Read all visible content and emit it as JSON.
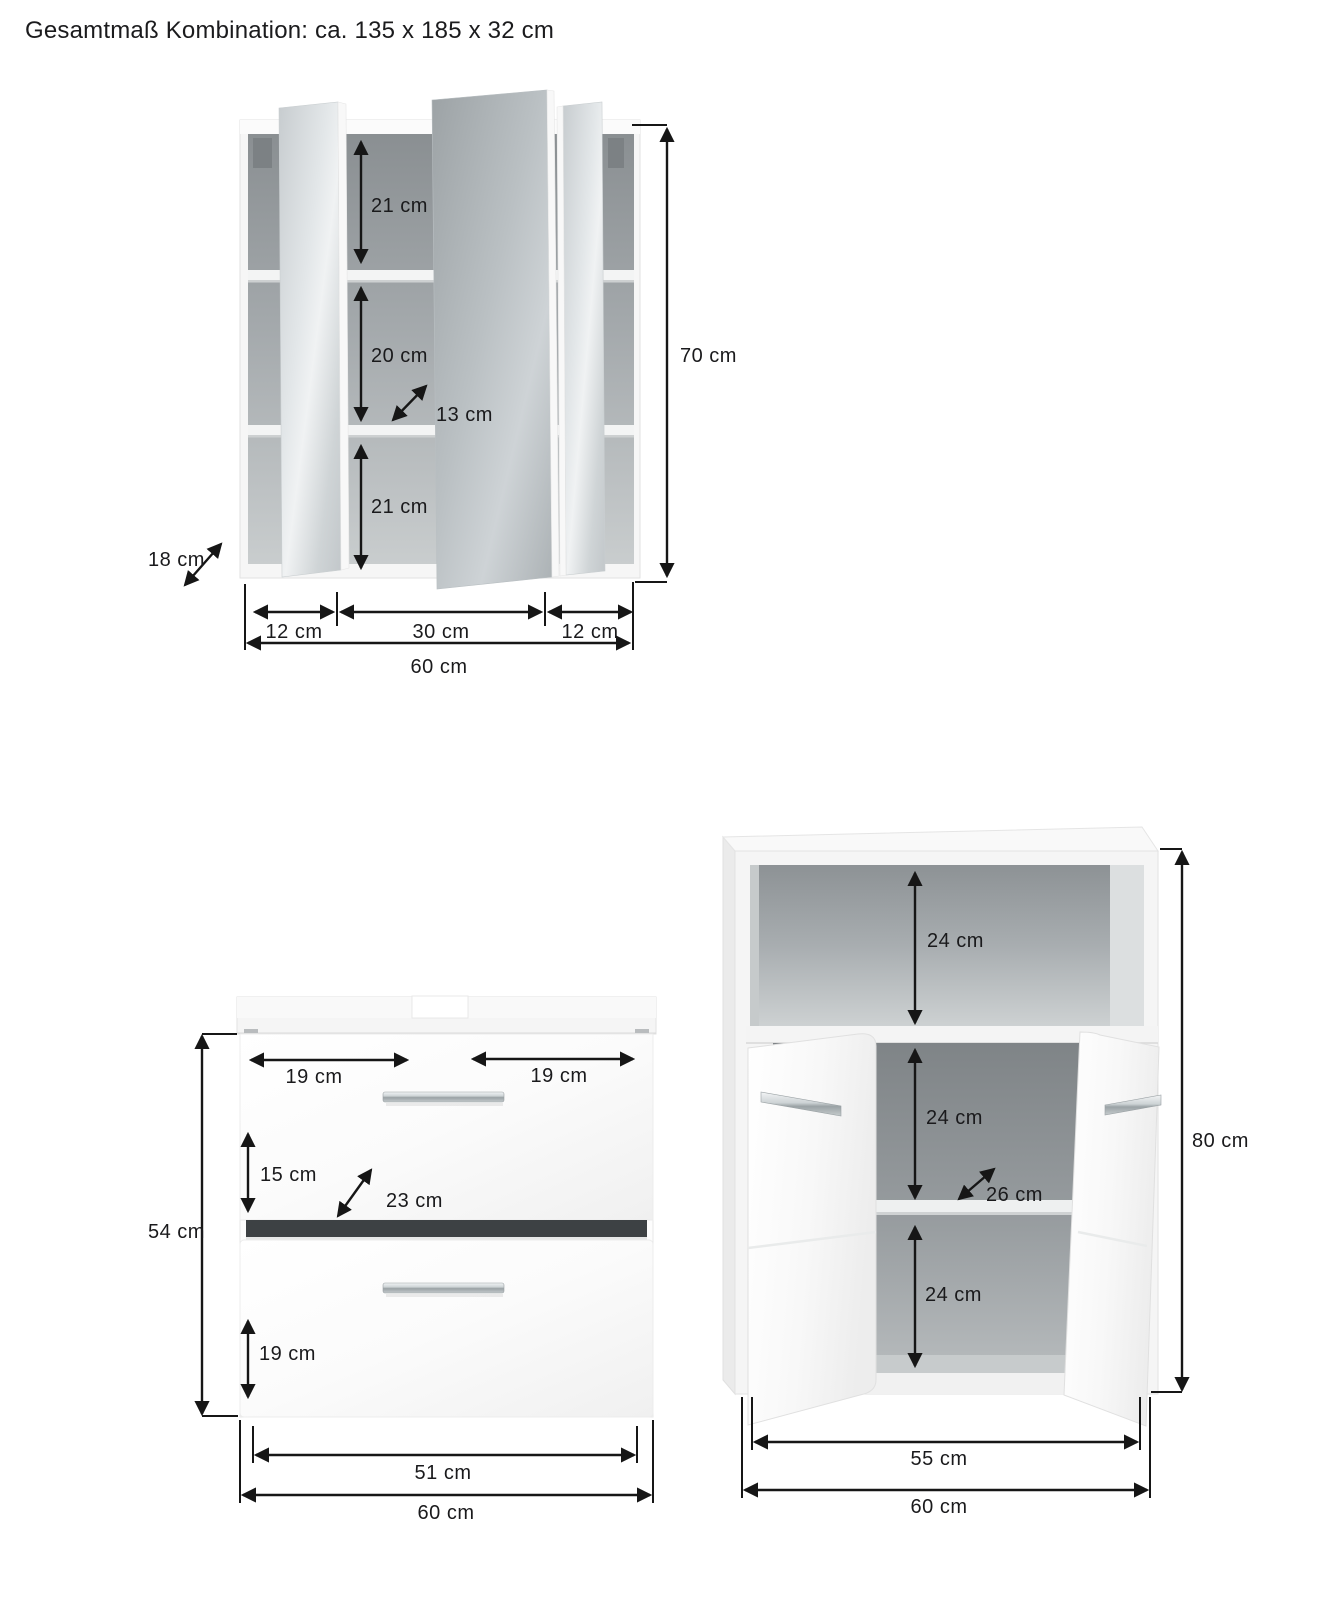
{
  "title": "Gesamtmaß Kombination: ca. 135 x 185 x 32 cm",
  "mirror_cabinet": {
    "compartment_top_height": "21 cm",
    "compartment_middle_height": "20 cm",
    "inner_depth": "13 cm",
    "compartment_bottom_height": "21 cm",
    "height_total": "70 cm",
    "depth_total": "18 cm",
    "width_left_section": "12 cm",
    "width_center_section": "30 cm",
    "width_right_section": "12 cm",
    "width_total": "60 cm"
  },
  "washbasin_cabinet": {
    "top_width_left": "19 cm",
    "top_width_right": "19 cm",
    "upper_drawer_height": "15 cm",
    "inner_depth": "23 cm",
    "lower_drawer_height": "19 cm",
    "height_total": "54 cm",
    "drawer_front_width": "51 cm",
    "width_total": "60 cm"
  },
  "side_cabinet": {
    "niche_height": "24 cm",
    "middle_compartment_height": "24 cm",
    "inner_depth": "26 cm",
    "bottom_compartment_height": "24 cm",
    "height_total": "80 cm",
    "inner_width": "55 cm",
    "width_total": "60 cm"
  }
}
